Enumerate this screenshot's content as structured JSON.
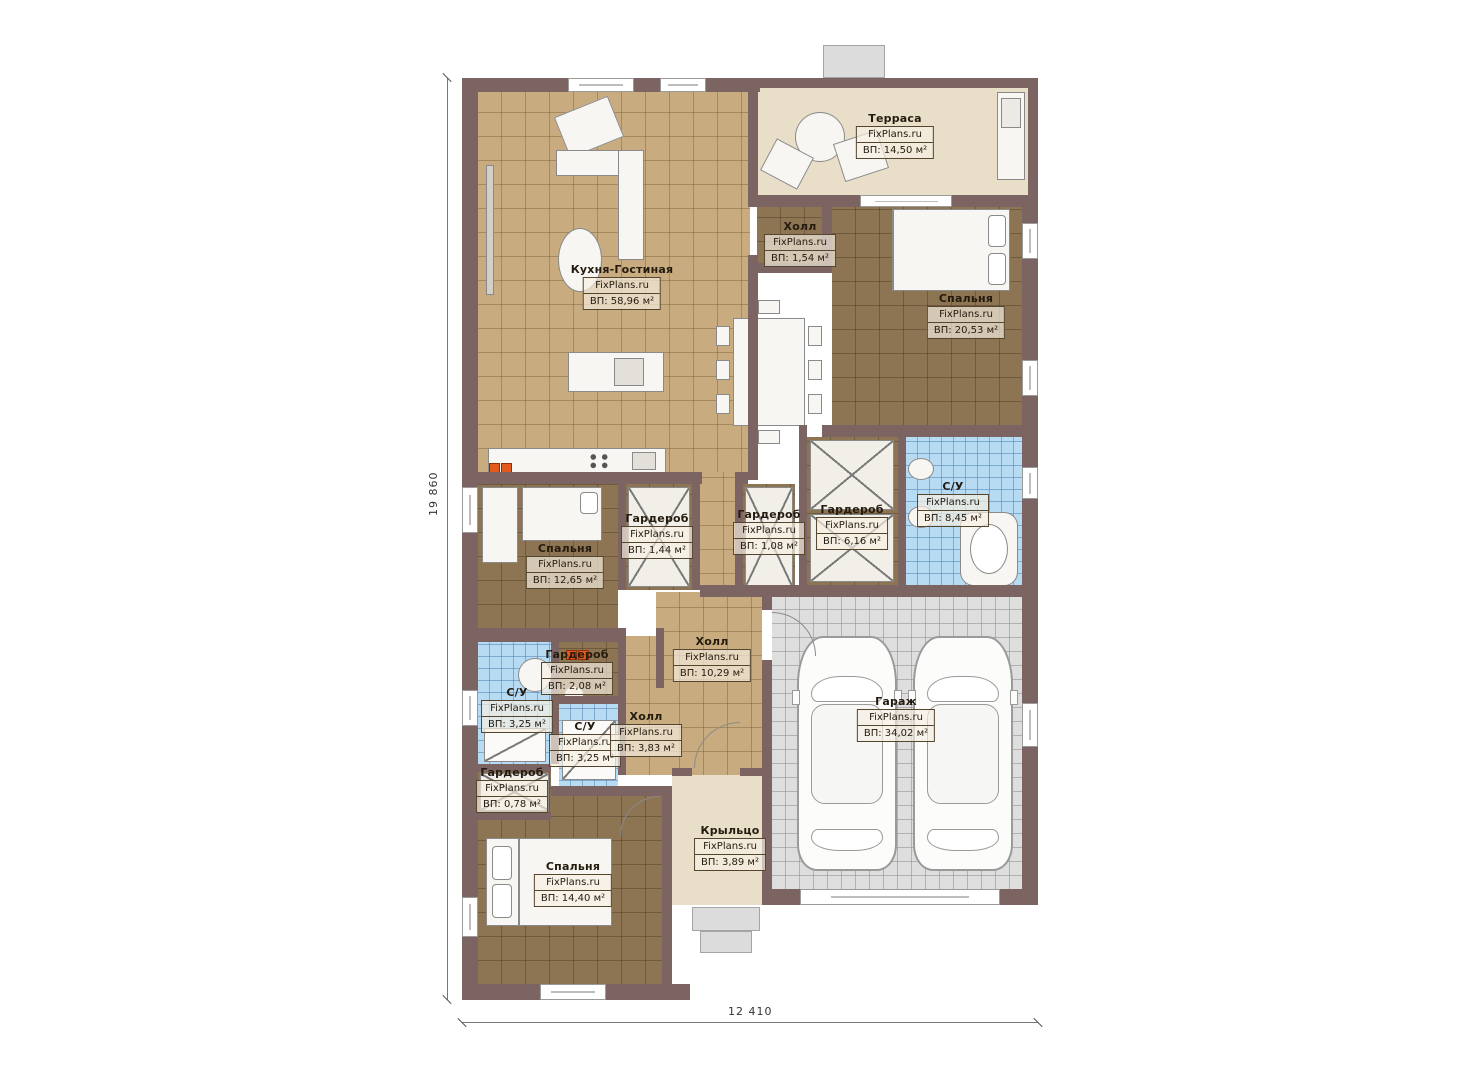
{
  "plan": {
    "brand": "FixPlans.ru",
    "overall_width_mm": "12 410",
    "overall_height_mm": "19 860"
  },
  "rooms": [
    {
      "name": "Кухня-Гостиная",
      "brand": "FixPlans.ru",
      "area": "ВП: 58,96 м²"
    },
    {
      "name": "Терраса",
      "brand": "FixPlans.ru",
      "area": "ВП: 14,50 м²"
    },
    {
      "name": "Холл",
      "brand": "FixPlans.ru",
      "area": "ВП: 1,54 м²"
    },
    {
      "name": "Спальня",
      "brand": "FixPlans.ru",
      "area": "ВП: 20,53 м²"
    },
    {
      "name": "С/У",
      "brand": "FixPlans.ru",
      "area": "ВП: 8,45 м²"
    },
    {
      "name": "Гардероб",
      "brand": "FixPlans.ru",
      "area": "ВП: 6,16 м²"
    },
    {
      "name": "Гардероб",
      "brand": "FixPlans.ru",
      "area": "ВП: 1,08 м²"
    },
    {
      "name": "Гардероб",
      "brand": "FixPlans.ru",
      "area": "ВП: 1,44 м²"
    },
    {
      "name": "Спальня",
      "brand": "FixPlans.ru",
      "area": "ВП: 12,65 м²"
    },
    {
      "name": "Холл",
      "brand": "FixPlans.ru",
      "area": "ВП: 10,29 м²"
    },
    {
      "name": "Гараж",
      "brand": "FixPlans.ru",
      "area": "ВП: 34,02 м²"
    },
    {
      "name": "С/У",
      "brand": "FixPlans.ru",
      "area": "ВП: 3,25 м²"
    },
    {
      "name": "Гардероб",
      "brand": "FixPlans.ru",
      "area": "ВП: 2,08 м²"
    },
    {
      "name": "С/У",
      "brand": "FixPlans.ru",
      "area": "ВП: 3,25 м²"
    },
    {
      "name": "Холл",
      "brand": "FixPlans.ru",
      "area": "ВП: 3,83 м²"
    },
    {
      "name": "Гардероб",
      "brand": "FixPlans.ru",
      "area": "ВП: 0,78 м²"
    },
    {
      "name": "Спальня",
      "brand": "FixPlans.ru",
      "area": "ВП: 14,40 м²"
    },
    {
      "name": "Крыльцо",
      "brand": "FixPlans.ru",
      "area": "ВП: 3,89 м²"
    }
  ],
  "dimensions": {
    "left_vertical": "19 860",
    "bottom_horizontal": "12 410"
  },
  "colors": {
    "wall": "#7c6462",
    "floor_tile_tan": "#c8ab7e",
    "floor_tile_brown": "#8d7453",
    "floor_tile_blue": "#b7dbf3",
    "floor_garage_gray": "#dedede",
    "floor_terrace_beige": "#e9dfc9",
    "accent_orange": "#e05a1e"
  }
}
